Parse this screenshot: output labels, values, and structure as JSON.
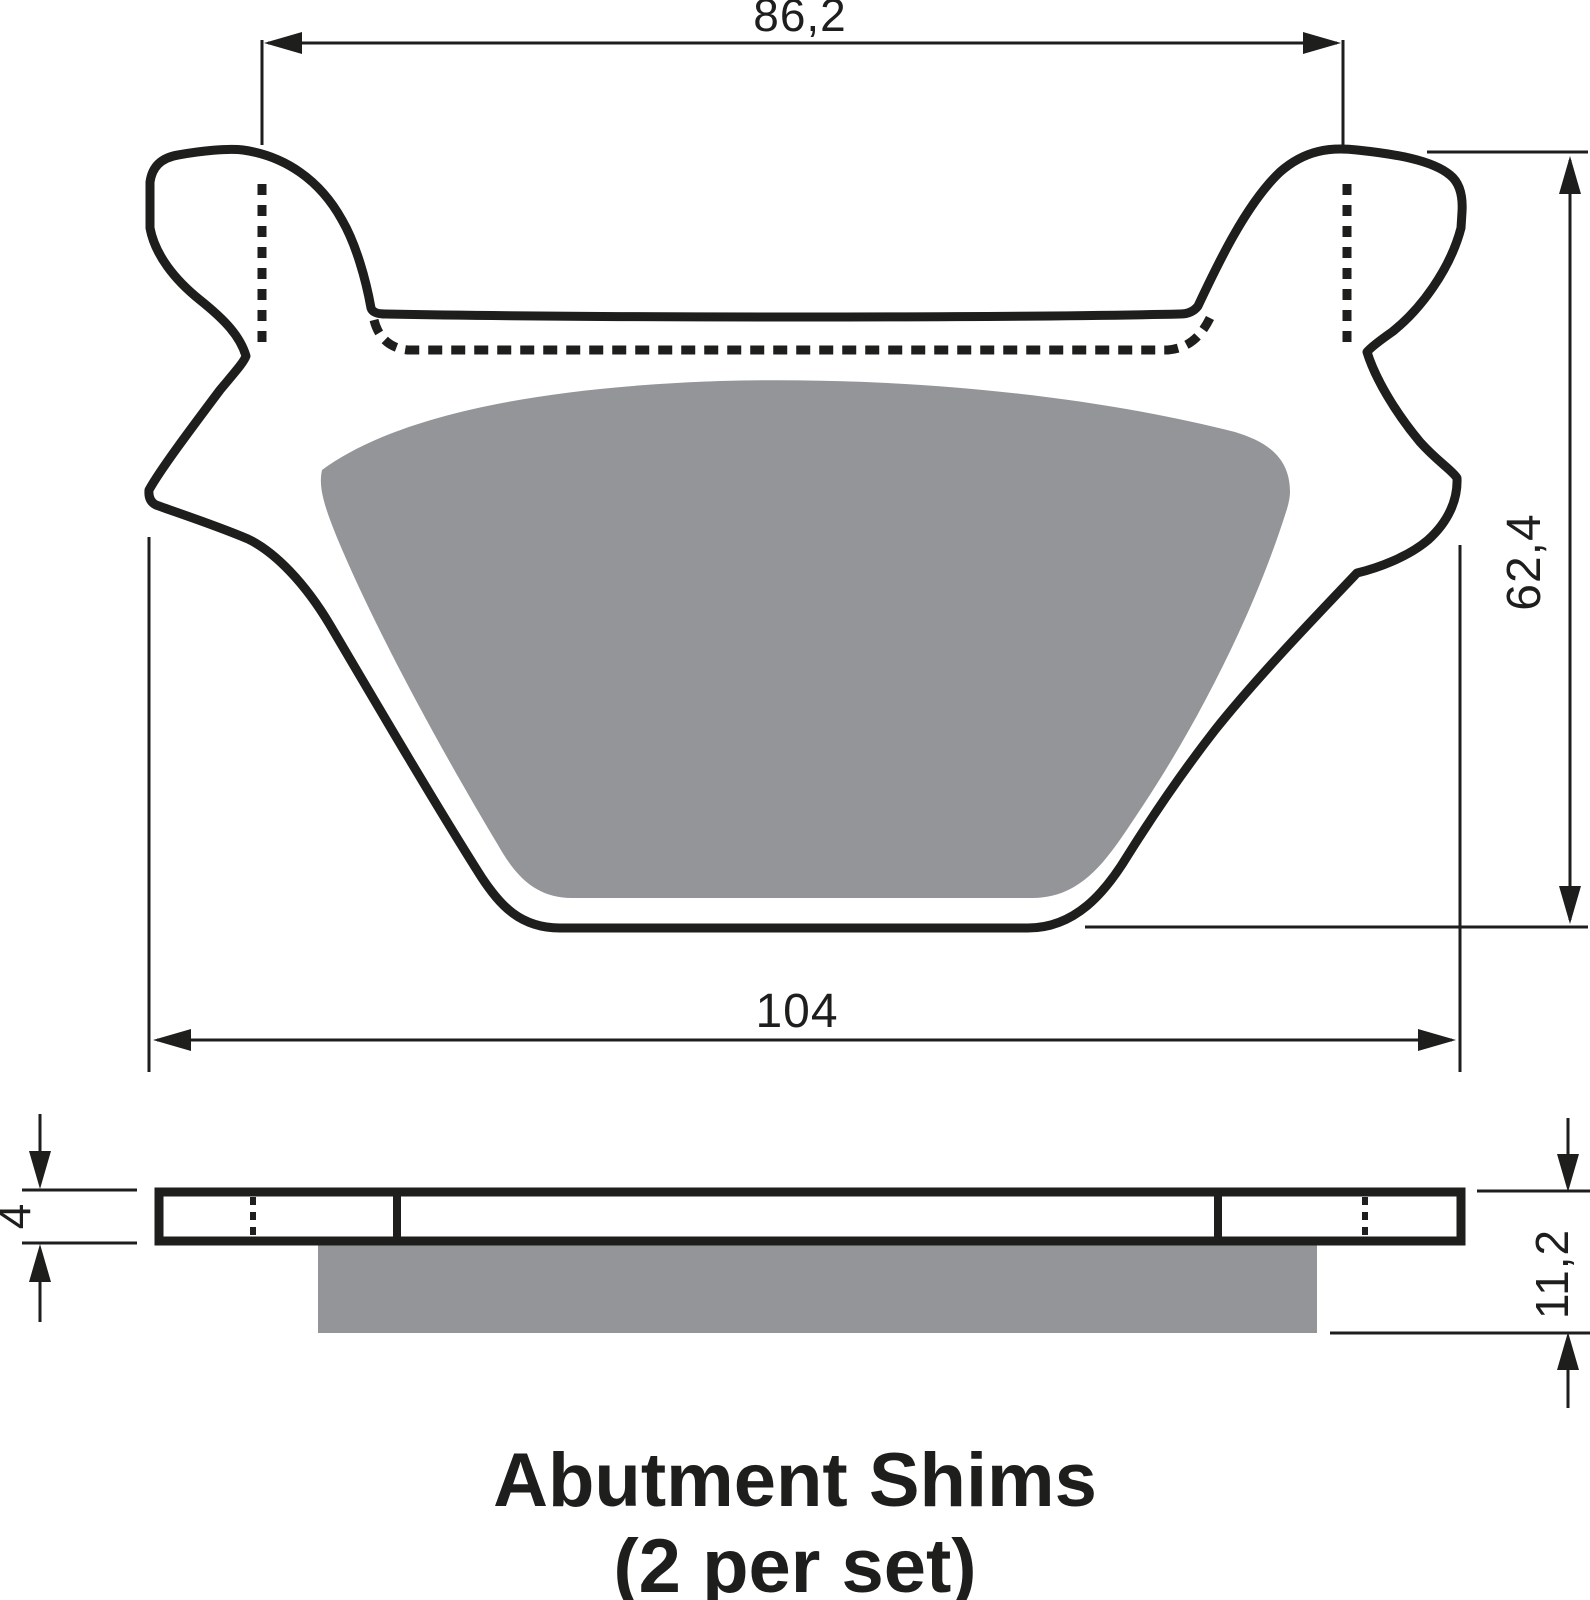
{
  "drawing": {
    "title_line1": "Abutment Shims",
    "title_line2": "(2 per set)",
    "dimensions": {
      "ears_center_width": "86,2",
      "overall_width": "104",
      "overall_height": "62,4",
      "shim_plate_thickness": "4",
      "pad_total_thickness": "11,2"
    },
    "colors": {
      "ink": "#1e1e1c",
      "friction_gray": "#939598",
      "background": "#ffffff"
    }
  }
}
